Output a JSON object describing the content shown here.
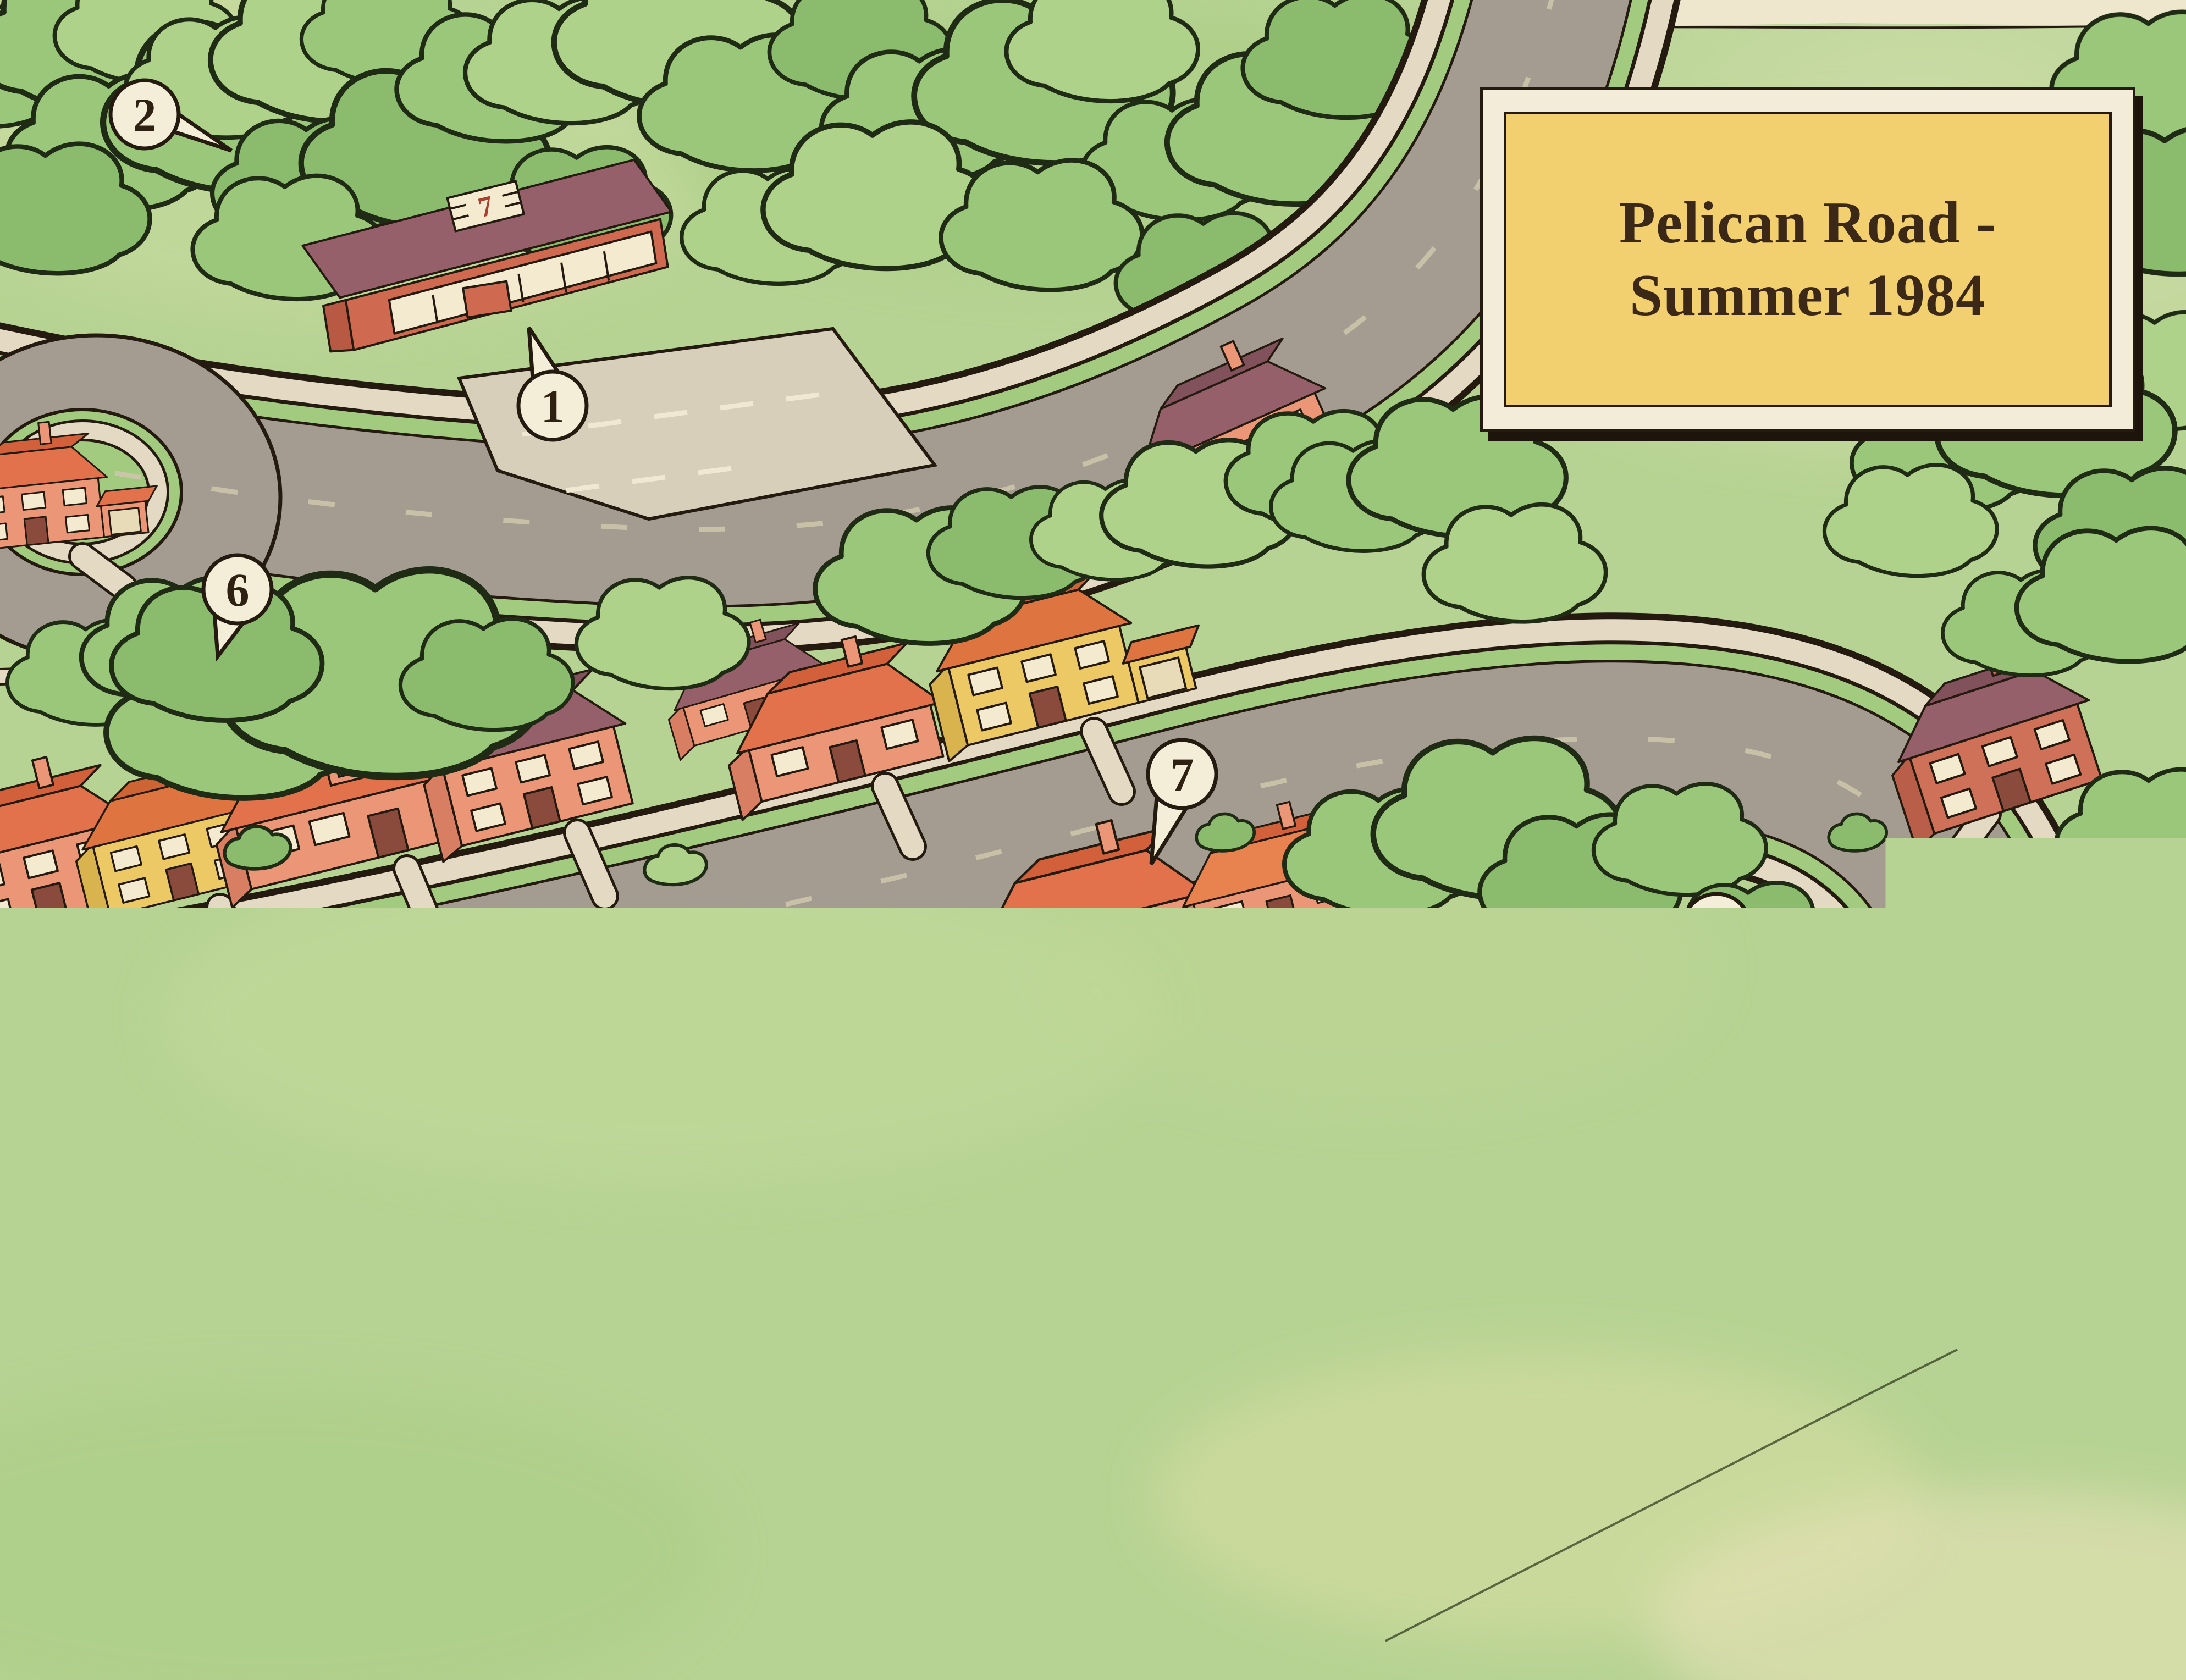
{
  "map": {
    "title_line1": "Pelican Road -",
    "title_line2": "Summer 1984"
  },
  "store_sign": "7",
  "legend": {
    "separator": "-",
    "items": [
      {
        "num": "1",
        "label": "The 7-11"
      },
      {
        "num": "2",
        "label": "Ranko’s Tent"
      },
      {
        "num": "3",
        "label": "The Boarding House"
      },
      {
        "num": "4",
        "label": "Palmer’s House"
      },
      {
        "num": "5",
        "label": "The Melvilles’ House"
      },
      {
        "num": "6",
        "label": "The Treehouse"
      },
      {
        "num": "7",
        "label": "Lila’s House"
      },
      {
        "num": "8",
        "label": "Mrs Wilson’s House"
      },
      {
        "num": "9",
        "label": "Where The Body Was"
      }
    ]
  },
  "markers": [
    {
      "number": "1",
      "location": "The 7-11"
    },
    {
      "number": "2",
      "location": "Ranko’s Tent"
    },
    {
      "number": "3",
      "location": "The Boarding House"
    },
    {
      "number": "4",
      "location": "Palmer’s House"
    },
    {
      "number": "5",
      "location": "The Melvilles’ House"
    },
    {
      "number": "6",
      "location": "The Treehouse"
    },
    {
      "number": "7",
      "location": "Lila’s House"
    },
    {
      "number": "8",
      "location": "Mrs Wilson’s House"
    },
    {
      "number": "9",
      "location": "Where The Body Was"
    }
  ]
}
